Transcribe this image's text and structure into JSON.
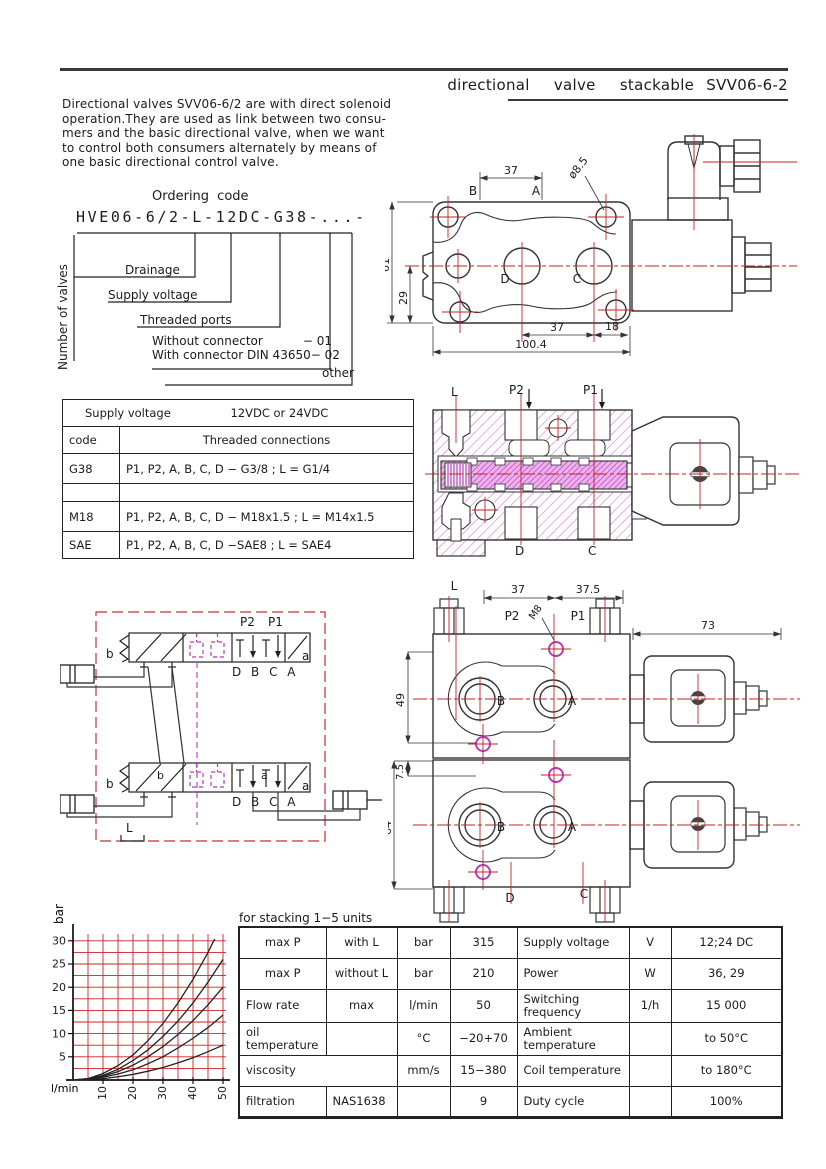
{
  "page": {
    "title": "directional  valve  stackable SVV06-6-2",
    "intro_lines": [
      "Directional valves SVV06-6/2 are with direct solenoid",
      "operation.They are used as link between two consu-",
      "mers and the basic directional valve, when we want",
      "to control both consumers alternately by means of",
      "one basic directional control valve."
    ]
  },
  "ordering": {
    "heading": "Ordering code",
    "code": "HVE06-6/2-L-12DC-G38-...-",
    "number_of_valves": "Number of valves",
    "drainage": "Drainage",
    "supply_voltage": "Supply voltage",
    "threaded_ports": "Threaded ports",
    "without_connector": "Without connector",
    "without_code": "− 01",
    "with_connector": "With connector DIN 43650",
    "with_code": "− 02",
    "other": "other"
  },
  "threaded_table": {
    "header_label": "Supply voltage",
    "header_value": "12VDC or 24VDC",
    "code_header": "code",
    "conn_header": "Threaded connections",
    "rows": [
      {
        "code": "G38",
        "conn": "P1, P2, A, B, C, D − G3/8 ; L = G1/4"
      },
      {
        "code": "",
        "conn": ""
      },
      {
        "code": "M18",
        "conn": "P1, P2, A, B, C, D − M18x1.5 ; L = M14x1.5"
      },
      {
        "code": "SAE",
        "conn": "P1, P2, A, B, C, D −SAE8 ; L = SAE4"
      }
    ]
  },
  "drawing_top": {
    "dim_37_top": "37",
    "dia": "ø8.5",
    "b": "B",
    "a": "A",
    "dim_61": "61",
    "dim_29": "29",
    "d": "D",
    "c": "C",
    "dim_37_bottom": "37",
    "dim_18": "18",
    "dim_total": "100.4"
  },
  "drawing_section": {
    "l": "L",
    "p2": "P2",
    "p1": "P1",
    "d": "D",
    "c": "C"
  },
  "schematic": {
    "p2": "P2",
    "p1": "P1",
    "b": "b",
    "a": "a",
    "ports": "D B C A",
    "l": "L"
  },
  "drawing_stack": {
    "l": "L",
    "dim_37": "37",
    "dim_375": "37.5",
    "m8": "M8",
    "p2": "P2",
    "p1": "P1",
    "dim_73": "73",
    "dim_49": "49",
    "dim_75": "7.5",
    "dim_64": "64",
    "b": "B",
    "a": "A",
    "d": "D",
    "c": "C"
  },
  "chart_data": {
    "type": "line",
    "xlabel": "l/min",
    "ylabel": "bar",
    "x": [
      0,
      5,
      10,
      15,
      20,
      25,
      30,
      35,
      40,
      45,
      50
    ],
    "xticks": [
      "10",
      "20",
      "30",
      "40",
      "50"
    ],
    "yticks": [
      "5",
      "10",
      "15",
      "20",
      "25",
      "30"
    ],
    "xlim": [
      0,
      52
    ],
    "ylim": [
      0,
      32
    ],
    "grid": true,
    "grid_color": "#cc2222",
    "legend": "none",
    "series": [
      {
        "name": "curve-1",
        "values": [
          0,
          0.3,
          1.4,
          3.1,
          5.4,
          8.5,
          12.2,
          16.6,
          21.7,
          27.5,
          34.0
        ]
      },
      {
        "name": "curve-2",
        "values": [
          0,
          0.3,
          1.0,
          2.3,
          4.2,
          6.5,
          9.4,
          12.7,
          16.6,
          21.1,
          26.0
        ]
      },
      {
        "name": "curve-3",
        "values": [
          0,
          0.2,
          0.8,
          1.8,
          3.2,
          5.0,
          7.2,
          9.8,
          12.8,
          16.2,
          20.0
        ]
      },
      {
        "name": "curve-4",
        "values": [
          0,
          0.1,
          0.6,
          1.3,
          2.2,
          3.5,
          5.0,
          6.9,
          9.0,
          11.3,
          14.0
        ]
      },
      {
        "name": "curve-5",
        "values": [
          0,
          0.1,
          0.3,
          0.7,
          1.2,
          1.9,
          2.7,
          3.7,
          4.8,
          6.1,
          7.5
        ]
      }
    ]
  },
  "spec_table": {
    "caption": "for stacking 1−5 units",
    "rows": [
      [
        "max P",
        "with L",
        "bar",
        "315",
        "Supply voltage",
        "V",
        "12;24 DC"
      ],
      [
        "max P",
        "without L",
        "bar",
        "210",
        "Power",
        "W",
        "36, 29"
      ],
      [
        "Flow rate",
        "max",
        "l/min",
        "50",
        "Switching frequency",
        "1/h",
        "15 000"
      ],
      [
        "oil temperature",
        "",
        "°C",
        "−20+70",
        "Ambient temperature",
        "",
        "to 50°C"
      ],
      [
        "viscosity",
        "",
        "mm/s",
        "15−380",
        "Coil temperature",
        "",
        "to 180°C"
      ],
      [
        "filtration",
        "NAS1638",
        "",
        "9",
        "Duty cycle",
        "",
        "100%"
      ]
    ]
  },
  "colors": {
    "centerline_red": "#c42222",
    "chart_grid_red": "#cc2222",
    "schematic_border_red": "#c43030",
    "hatch_magenta": "#d678d6",
    "spool_magenta": "#b83ab8",
    "line_dark": "#333333"
  }
}
